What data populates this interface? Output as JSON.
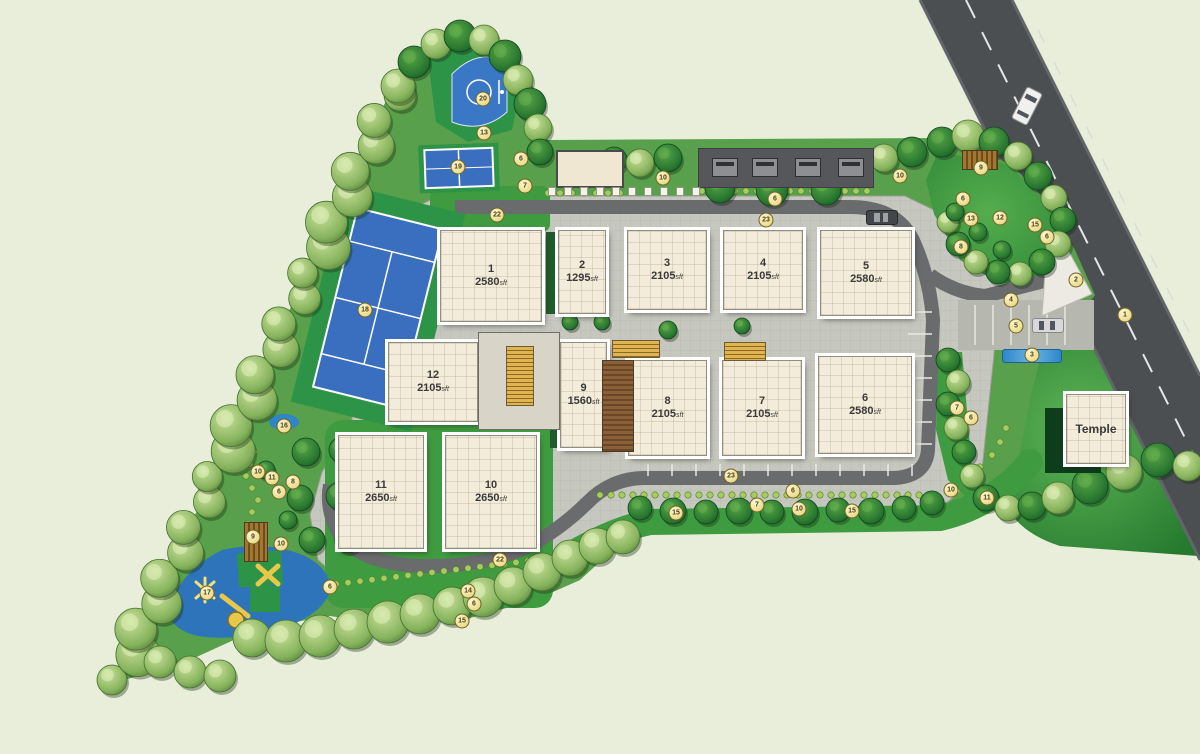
{
  "plan": {
    "area_unit": "sft",
    "temple_label": "Temple"
  },
  "buildings": [
    {
      "no": "1",
      "area": "2580",
      "x": 440,
      "y": 230,
      "w": 100,
      "h": 90
    },
    {
      "no": "2",
      "area": "1295",
      "x": 558,
      "y": 230,
      "w": 46,
      "h": 82
    },
    {
      "no": "3",
      "area": "2105",
      "x": 627,
      "y": 230,
      "w": 78,
      "h": 78
    },
    {
      "no": "4",
      "area": "2105",
      "x": 723,
      "y": 230,
      "w": 78,
      "h": 78
    },
    {
      "no": "5",
      "area": "2580",
      "x": 820,
      "y": 230,
      "w": 90,
      "h": 84
    },
    {
      "no": "6",
      "area": "2580",
      "x": 818,
      "y": 356,
      "w": 92,
      "h": 96
    },
    {
      "no": "7",
      "area": "2105",
      "x": 722,
      "y": 360,
      "w": 78,
      "h": 94
    },
    {
      "no": "8",
      "area": "2105",
      "x": 628,
      "y": 360,
      "w": 77,
      "h": 94
    },
    {
      "no": "9",
      "area": "1560",
      "x": 560,
      "y": 342,
      "w": 45,
      "h": 104
    },
    {
      "no": "10",
      "area": "2650",
      "x": 445,
      "y": 435,
      "w": 90,
      "h": 112
    },
    {
      "no": "11",
      "area": "2650",
      "x": 338,
      "y": 435,
      "w": 84,
      "h": 112
    },
    {
      "no": "12",
      "area": "2105",
      "x": 388,
      "y": 342,
      "w": 88,
      "h": 78
    }
  ],
  "markers": [
    {
      "n": "20",
      "x": 483,
      "y": 99
    },
    {
      "n": "13",
      "x": 484,
      "y": 133
    },
    {
      "n": "19",
      "x": 458,
      "y": 167
    },
    {
      "n": "6",
      "x": 521,
      "y": 159
    },
    {
      "n": "7",
      "x": 525,
      "y": 186
    },
    {
      "n": "22",
      "x": 497,
      "y": 215
    },
    {
      "n": "18",
      "x": 365,
      "y": 310
    },
    {
      "n": "10",
      "x": 663,
      "y": 178
    },
    {
      "n": "6",
      "x": 775,
      "y": 199
    },
    {
      "n": "23",
      "x": 766,
      "y": 220
    },
    {
      "n": "10",
      "x": 900,
      "y": 176
    },
    {
      "n": "9",
      "x": 981,
      "y": 168
    },
    {
      "n": "6",
      "x": 963,
      "y": 199
    },
    {
      "n": "13",
      "x": 971,
      "y": 219
    },
    {
      "n": "12",
      "x": 1000,
      "y": 218
    },
    {
      "n": "15",
      "x": 1035,
      "y": 225
    },
    {
      "n": "6",
      "x": 1047,
      "y": 237
    },
    {
      "n": "8",
      "x": 961,
      "y": 247
    },
    {
      "n": "2",
      "x": 1076,
      "y": 280
    },
    {
      "n": "4",
      "x": 1011,
      "y": 300
    },
    {
      "n": "5",
      "x": 1016,
      "y": 326
    },
    {
      "n": "1",
      "x": 1125,
      "y": 315
    },
    {
      "n": "3",
      "x": 1032,
      "y": 355
    },
    {
      "n": "7",
      "x": 957,
      "y": 408
    },
    {
      "n": "6",
      "x": 971,
      "y": 418
    },
    {
      "n": "10",
      "x": 951,
      "y": 490
    },
    {
      "n": "11",
      "x": 987,
      "y": 498
    },
    {
      "n": "23",
      "x": 731,
      "y": 476
    },
    {
      "n": "6",
      "x": 793,
      "y": 491
    },
    {
      "n": "7",
      "x": 757,
      "y": 505
    },
    {
      "n": "10",
      "x": 799,
      "y": 509
    },
    {
      "n": "15",
      "x": 852,
      "y": 511
    },
    {
      "n": "15",
      "x": 676,
      "y": 513
    },
    {
      "n": "22",
      "x": 500,
      "y": 560
    },
    {
      "n": "14",
      "x": 468,
      "y": 591
    },
    {
      "n": "6",
      "x": 474,
      "y": 604
    },
    {
      "n": "15",
      "x": 462,
      "y": 621
    },
    {
      "n": "16",
      "x": 284,
      "y": 426
    },
    {
      "n": "10",
      "x": 258,
      "y": 472
    },
    {
      "n": "11",
      "x": 272,
      "y": 478
    },
    {
      "n": "8",
      "x": 293,
      "y": 482
    },
    {
      "n": "6",
      "x": 279,
      "y": 492
    },
    {
      "n": "9",
      "x": 253,
      "y": 537
    },
    {
      "n": "10",
      "x": 281,
      "y": 544
    },
    {
      "n": "17",
      "x": 207,
      "y": 593
    },
    {
      "n": "6",
      "x": 330,
      "y": 587
    }
  ],
  "colors": {
    "background": "#e9eedb",
    "paving": "#c6c7bf",
    "road": "#4b4f52",
    "lawn": "#3f9b3f",
    "court_blue": "#3a6fc0",
    "court_green": "#2d9447",
    "building_fill": "#f3ecda",
    "marker_fill": "#f4e9a8",
    "tree_dark": "#1e6b2e",
    "tree_light": "#8fbc62"
  }
}
